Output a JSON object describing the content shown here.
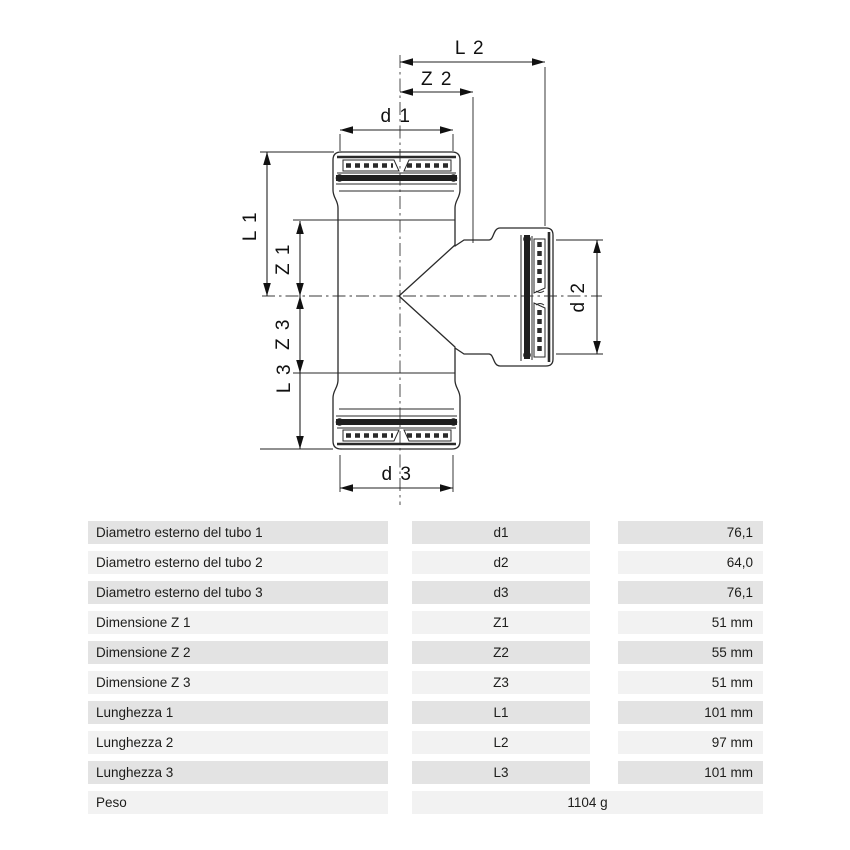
{
  "diagram": {
    "labels": {
      "l2": "L 2",
      "z2": "Z 2",
      "d1": "d 1",
      "l1": "L 1",
      "z1": "Z 1",
      "z3": "Z 3",
      "l3": "L 3",
      "d2": "d 2",
      "d3": "d 3"
    }
  },
  "table": {
    "rows": [
      {
        "label": "Diametro esterno del tubo 1",
        "symbol": "d1",
        "value": "76,1"
      },
      {
        "label": "Diametro esterno del tubo 2",
        "symbol": "d2",
        "value": "64,0"
      },
      {
        "label": "Diametro esterno del tubo 3",
        "symbol": "d3",
        "value": "76,1"
      },
      {
        "label": "Dimensione Z 1",
        "symbol": "Z1",
        "value": "51 mm"
      },
      {
        "label": "Dimensione Z 2",
        "symbol": "Z2",
        "value": "55 mm"
      },
      {
        "label": "Dimensione Z 3",
        "symbol": "Z3",
        "value": "51 mm"
      },
      {
        "label": "Lunghezza 1",
        "symbol": "L1",
        "value": "101 mm"
      },
      {
        "label": "Lunghezza 2",
        "symbol": "L2",
        "value": "97 mm"
      },
      {
        "label": "Lunghezza 3",
        "symbol": "L3",
        "value": "101 mm"
      }
    ],
    "weight_row": {
      "label": "Peso",
      "value": "1104 g"
    }
  },
  "colors": {
    "row_dark": "#e3e3e3",
    "row_light": "#f2f2f2",
    "line": "#222222"
  }
}
